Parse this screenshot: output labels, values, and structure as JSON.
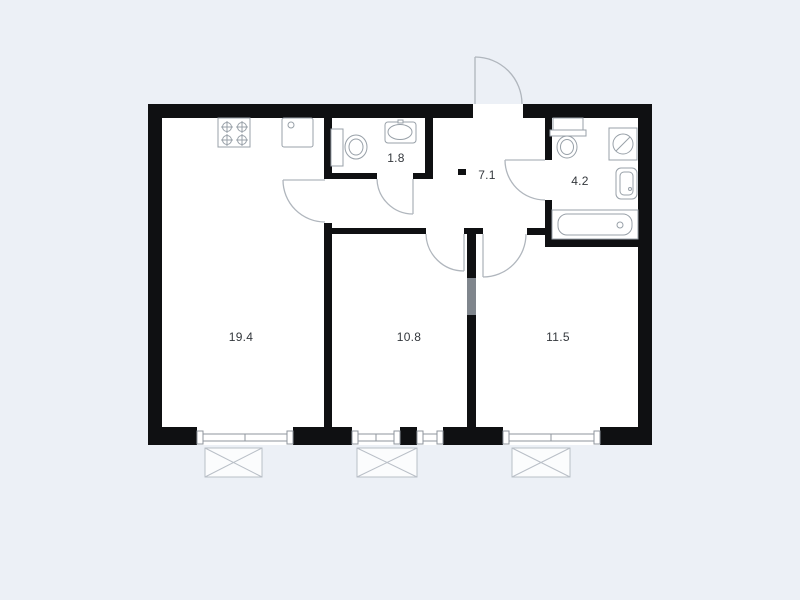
{
  "floor_plan": {
    "rooms": [
      {
        "id": "living-kitchen",
        "area": "19.4"
      },
      {
        "id": "bedroom-middle",
        "area": "10.8"
      },
      {
        "id": "bedroom-right",
        "area": "11.5"
      },
      {
        "id": "hallway",
        "area": "7.1"
      },
      {
        "id": "wc",
        "area": "1.8"
      },
      {
        "id": "bathroom",
        "area": "4.2"
      }
    ],
    "fixtures": [
      "stove-icon",
      "kitchen-sink-icon",
      "wc-toilet-icon",
      "wc-washbasin-icon",
      "bathroom-toilet-icon",
      "washing-machine-icon",
      "bathroom-washbasin-icon",
      "bathtub-icon"
    ],
    "symbols": [
      "entrance-door-arc",
      "kitchen-door-arc",
      "wc-door-arc",
      "bathroom-door-arc",
      "bedroom-middle-door-arc",
      "bedroom-right-door-arc",
      "window-symbol",
      "balcony-slab-box"
    ],
    "colors": {
      "background": "#ecf0f6",
      "wall": "#0f1012",
      "room_fill": "#ffffff",
      "partition_gray": "#7f858c",
      "fixture_outline": "#98a0a8",
      "door_arc": "#b0b6bd",
      "label_text": "#33373c"
    }
  }
}
